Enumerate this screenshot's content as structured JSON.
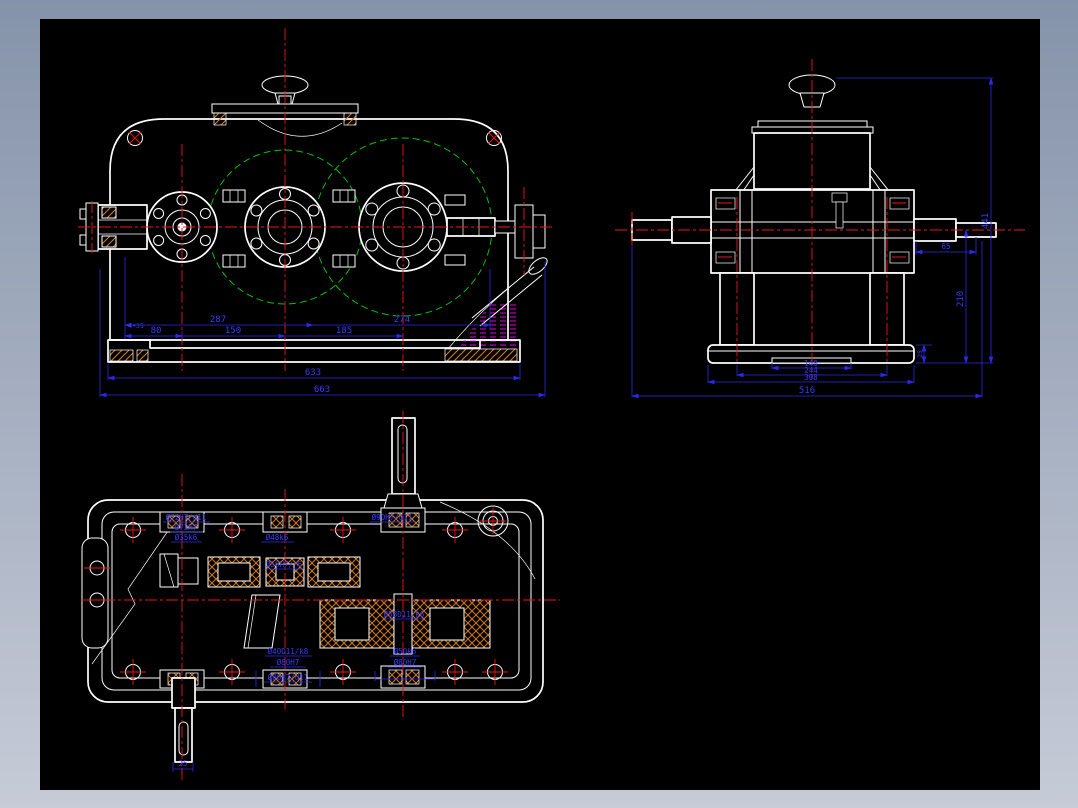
{
  "frame": {
    "border_color_top": "#8593aa",
    "border_color_bottom": "#c6cbd7",
    "canvas_background": "#000000"
  },
  "palette": {
    "outline": "#ffffff",
    "centerline": "#ee1515",
    "pitch_circle": "#00c400",
    "dimension": "#3939ff",
    "section_hatch": "#d4781e",
    "oil_hatch": "#e000e0"
  },
  "views": {
    "front": {
      "dim_span_left": "287",
      "dim_span_right": "274",
      "note": "4+35",
      "dim_a": "80",
      "dim_b": "150",
      "dim_c": "185",
      "dim_base": "633",
      "dim_overall": "663"
    },
    "side": {
      "dim_height": "441",
      "dim_axis_height": "210",
      "dim_shaft_ext": "65",
      "dim_base_thk": "25",
      "dim_pad": "140",
      "dim_legs": "244",
      "dim_base": "308",
      "dim_overall": "516"
    },
    "plan": {
      "fits": {
        "input_cover": "Ø72H7/d11",
        "input_bearing": "Ø72H7",
        "input_shaft": "Ø35k6",
        "mid_top": "Ø48k6",
        "output_cover": "Ø90H7/d11",
        "mid_fit": "Ø50H7/r6",
        "gear_fit": "Ø58D11/k6",
        "bottom_cover": "Ø40D11/k8",
        "bottom_bearing": "Ø80H7",
        "bottom_cover_fit": "Ø80H7/d11",
        "out_bearing_a": "Ø50k6",
        "out_bearing_b": "Ø80H7",
        "shaft_end": "25"
      }
    }
  }
}
